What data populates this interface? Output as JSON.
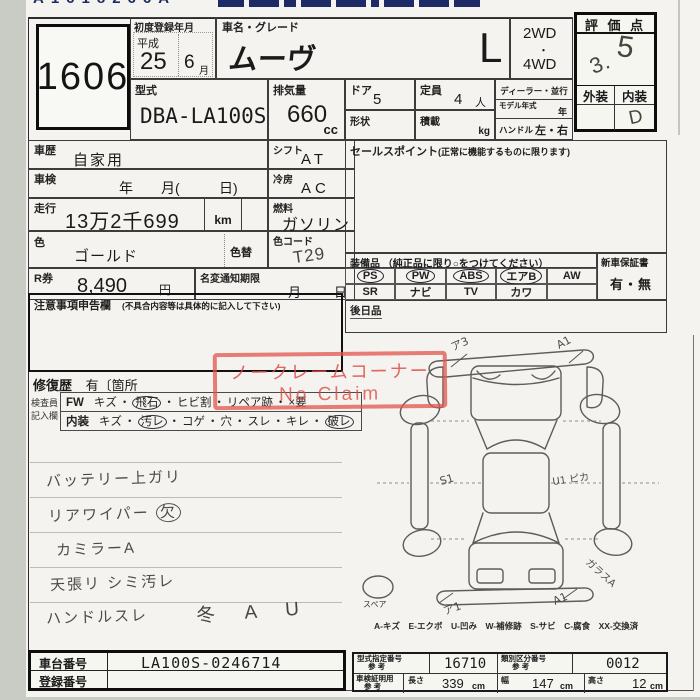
{
  "header": {
    "code": "A1618266A"
  },
  "lot_no": "1606",
  "first_reg": {
    "label": "初度登録年月",
    "era": "平成",
    "year": "25",
    "month": "6",
    "month_unit": "月"
  },
  "name_grade": {
    "label": "車名・グレード",
    "name": "ムーヴ",
    "grade": "L"
  },
  "drive": {
    "line1": "2WD",
    "dot": "・",
    "line2": "4WD"
  },
  "score": {
    "label": "評 価 点",
    "value": "3.",
    "value2": "5",
    "ext_label": "外装",
    "int_label": "内装",
    "int_value": "D"
  },
  "model_code": {
    "label": "型式",
    "value": "DBA-LA100S"
  },
  "displacement": {
    "label": "排気量",
    "value": "660",
    "unit": "cc"
  },
  "doors": {
    "label": "ドア",
    "value": "5"
  },
  "shape": {
    "label": "形状"
  },
  "capacity": {
    "label": "定員",
    "value": "4",
    "unit": "人"
  },
  "payload": {
    "label": "積載",
    "unit": "kg"
  },
  "dealer_parallel": {
    "label": "ディーラー・並行"
  },
  "model_year": {
    "label": "モデル年式",
    "unit": "年"
  },
  "steering": {
    "label": "ハンドル",
    "value": "左・右"
  },
  "history": {
    "label": "車歴",
    "value": "自家用"
  },
  "shaken": {
    "label": "車検",
    "y": "年",
    "m": "月(",
    "d": "日)"
  },
  "mileage": {
    "label": "走行",
    "value": "13万2千699",
    "unit": "km"
  },
  "shift": {
    "label": "シフト",
    "value": "AT"
  },
  "aircon": {
    "label": "冷房",
    "value": "AC"
  },
  "fuel": {
    "label": "燃料",
    "value": "ガソリン"
  },
  "color": {
    "label": "色",
    "value": "ゴールド",
    "change_label": "色替"
  },
  "color_code": {
    "label": "色コード",
    "value": "T29"
  },
  "r_ticket": {
    "label": "R券",
    "value": "8,490",
    "unit": "円"
  },
  "name_change": {
    "label": "名変通知期限",
    "month": "月",
    "day": "日"
  },
  "sales_point": {
    "label": "セールスポイント",
    "note": "(正常に機能するものに限ります)"
  },
  "equipment": {
    "label": "装備品 （純正品に限り○をつけてください）",
    "row1": [
      {
        "label": "PS",
        "circled": true
      },
      {
        "label": "PW",
        "circled": true
      },
      {
        "label": "ABS",
        "circled": true
      },
      {
        "label": "エアB",
        "circled": true
      },
      {
        "label": "AW",
        "circled": false
      }
    ],
    "row2": [
      {
        "label": "SR",
        "circled": false
      },
      {
        "label": "ナビ",
        "circled": false
      },
      {
        "label": "TV",
        "circled": false
      },
      {
        "label": "カワ",
        "circled": false
      },
      {
        "label": "",
        "circled": false
      }
    ]
  },
  "warranty": {
    "label": "新車保証書",
    "value": "有・無"
  },
  "later_goods": {
    "label": "後日品"
  },
  "caution": {
    "label": "注意事項申告欄",
    "note": "(不具合内容等は具体的に記入して下さい)"
  },
  "repair_history": {
    "label": "修復歴",
    "value": "有〔箇所"
  },
  "no_claim_stamp": {
    "line1": "ノークレームコーナー",
    "line2": "No Claim"
  },
  "inspector": {
    "label1": "検査員",
    "label2": "記入欄",
    "rows": [
      {
        "prefix": "FW",
        "items": [
          {
            "t": "キズ"
          },
          {
            "t": "飛石",
            "circled": true
          },
          {
            "t": "ヒビ割"
          },
          {
            "t": "リペア跡"
          },
          {
            "t": "×要"
          }
        ]
      },
      {
        "prefix": "内装",
        "items": [
          {
            "t": "キズ"
          },
          {
            "t": "汚レ",
            "circled": true
          },
          {
            "t": "コゲ"
          },
          {
            "t": "穴"
          },
          {
            "t": "スレ"
          },
          {
            "t": "キレ"
          },
          {
            "t": "破レ",
            "circled": true
          }
        ]
      }
    ]
  },
  "notes": [
    {
      "text": "バッテリー上ガリ"
    },
    {
      "text": "リアワイパー ",
      "circled": "欠"
    },
    {
      "text": "カミラーA"
    },
    {
      "text": "天張リ シミ汚レ"
    },
    {
      "text": "ハンドルスレ"
    }
  ],
  "bottom_mark": "冬 A U",
  "diagram": {
    "spare_label": "スペア",
    "marks": {
      "front_left": "ア3",
      "front_right": "A1",
      "side_left": "S1",
      "side_right": "U1 ピカ",
      "rear_right_side": "ガラスA",
      "rear_left": "ア1",
      "rear_right": "A1"
    },
    "legend": "A-キズ　E-エクボ　U-凹み　W-補修跡　S-サビ　C-腐食　XX-交換済"
  },
  "chassis": {
    "label": "車台番号",
    "value": "LA100S-0246714"
  },
  "plate": {
    "label": "登録番号",
    "value": ""
  },
  "type_cert": {
    "label": "型式指定番号",
    "sub": "参 考",
    "value": "16710"
  },
  "class_cert": {
    "label": "類別区分番号",
    "sub": "参 考",
    "value": "0012"
  },
  "dimensions": {
    "label": "車検証明用",
    "sub": "参 考",
    "len_label": "長さ",
    "len": "339",
    "wid_label": "幅",
    "wid": "147",
    "hgt_label": "高さ",
    "hgt": "12",
    "unit": "cm"
  }
}
